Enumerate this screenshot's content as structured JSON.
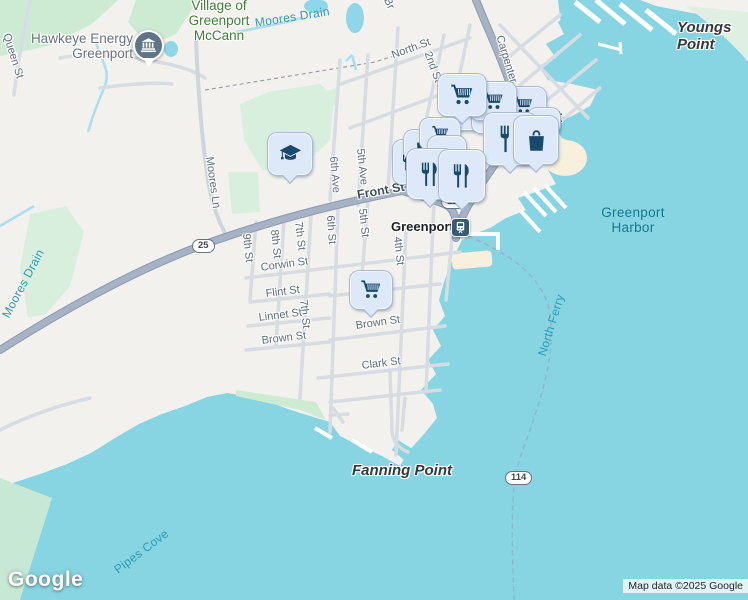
{
  "map": {
    "logo": "Google",
    "attribution": "Map data ©2025 Google",
    "colors": {
      "water": "#87d5e3",
      "land": "#f2f1ee",
      "park": "#cdebd3",
      "shallow": "#c7e8d4",
      "road_major": "#a7b2c4",
      "road_minor": "#d7dce3",
      "marker_bg": "#dde8f8",
      "marker_icon": "#174a6b",
      "station_badge": "#355c77",
      "pin": "#5d7587",
      "water_label": "#157a8d",
      "park_label": "#3f7d37",
      "street_label": "#5d6c7b"
    },
    "labels": [
      {
        "name": "label-hawkeye-energy",
        "cls": "poi-gray halo",
        "text": "Hawkeye Energy\nGreenport",
        "x": 133,
        "y": 31,
        "anchor": "tr",
        "align": "right"
      },
      {
        "name": "label-village-of-greenport-mccann",
        "cls": "poi-green halo",
        "text": "Village of\nGreenport\nMcCann",
        "x": 219,
        "y": -2,
        "anchor": "tc",
        "align": "center"
      },
      {
        "name": "label-youngs-point",
        "cls": "nature halo",
        "text": "Youngs Point",
        "x": 677,
        "y": 20
      },
      {
        "name": "label-fanning-point",
        "cls": "nature halo",
        "text": "Fanning Point",
        "x": 352,
        "y": 463
      },
      {
        "name": "label-greenport-town",
        "cls": "town halo",
        "text": "Greenport",
        "x": 483,
        "y": 109
      },
      {
        "name": "label-greenport-station",
        "cls": "station halo",
        "text": "Greenport",
        "x": 391,
        "y": 220
      },
      {
        "name": "label-greenport-harbor",
        "cls": "water-lg",
        "text": "Greenport\nHarbor",
        "x": 633,
        "y": 205,
        "anchor": "tc",
        "align": "center"
      },
      {
        "name": "label-pipes-cove",
        "cls": "water",
        "text": "Pipes Cove",
        "x": 112,
        "y": 566,
        "rot": -37
      },
      {
        "name": "label-north-ferry",
        "cls": "water",
        "text": "North Ferry",
        "x": 536,
        "y": 354,
        "rot": -73
      },
      {
        "name": "label-moores-drain-top",
        "cls": "water",
        "text": "Moores Drain",
        "x": 254,
        "y": 17,
        "rot": -9
      },
      {
        "name": "label-moores-drain-left",
        "cls": "water",
        "text": "Moores Drain",
        "x": 0,
        "y": 314,
        "rot": -62
      },
      {
        "name": "label-queen-st",
        "cls": "street halo",
        "text": "Queen St",
        "x": 12,
        "y": 32,
        "rot": 73
      },
      {
        "name": "label-north-st",
        "cls": "street halo",
        "text": "North St",
        "x": 390,
        "y": 50,
        "rot": -20
      },
      {
        "name": "label-2nd-st",
        "cls": "street halo",
        "text": "2nd St",
        "x": 433,
        "y": 50,
        "rot": 70
      },
      {
        "name": "label-br-fragment",
        "cls": "street halo",
        "text": "Br",
        "x": 392,
        "y": -4,
        "rot": 65
      },
      {
        "name": "label-carpenter",
        "cls": "street halo",
        "text": "Carpenter",
        "x": 505,
        "y": 34,
        "rot": 73
      },
      {
        "name": "label-moores-ln",
        "cls": "street halo",
        "text": "Moores Ln",
        "x": 215,
        "y": 156,
        "rot": 82
      },
      {
        "name": "label-6th-ave",
        "cls": "street halo",
        "text": "6th Ave",
        "x": 339,
        "y": 156,
        "rot": 85
      },
      {
        "name": "label-5th-ave",
        "cls": "street halo",
        "text": "5th Ave",
        "x": 366,
        "y": 148,
        "rot": 84
      },
      {
        "name": "label-front-st",
        "cls": "street-major halo",
        "text": "Front St",
        "x": 356,
        "y": 188,
        "rot": -10
      },
      {
        "name": "label-9th-st",
        "cls": "street halo",
        "text": "9th St",
        "x": 252,
        "y": 233,
        "rot": 84
      },
      {
        "name": "label-8th-st",
        "cls": "street halo",
        "text": "8th St",
        "x": 280,
        "y": 229,
        "rot": 84
      },
      {
        "name": "label-7th-st-upper",
        "cls": "street halo",
        "text": "7th St",
        "x": 304,
        "y": 221,
        "rot": 83
      },
      {
        "name": "label-6th-st",
        "cls": "street halo",
        "text": "6th St",
        "x": 336,
        "y": 215,
        "rot": 86
      },
      {
        "name": "label-5th-st",
        "cls": "street halo",
        "text": "5th St",
        "x": 368,
        "y": 208,
        "rot": 84
      },
      {
        "name": "label-4th-st",
        "cls": "street halo",
        "text": "4th St",
        "x": 403,
        "y": 236,
        "rot": 84
      },
      {
        "name": "label-7th-st-lower",
        "cls": "street halo",
        "text": "7th St",
        "x": 309,
        "y": 299,
        "rot": 84
      },
      {
        "name": "label-corwin-st",
        "cls": "street halo",
        "text": "Corwin St",
        "x": 260,
        "y": 262,
        "rot": -8
      },
      {
        "name": "label-flint-st",
        "cls": "street halo",
        "text": "Flint St",
        "x": 265,
        "y": 288,
        "rot": -7
      },
      {
        "name": "label-st-fragment",
        "cls": "street halo",
        "text": "St",
        "x": 380,
        "y": 286,
        "rot": -7
      },
      {
        "name": "label-linnet-st",
        "cls": "street halo",
        "text": "Linnet St",
        "x": 258,
        "y": 312,
        "rot": -7
      },
      {
        "name": "label-brown-st-west",
        "cls": "street halo",
        "text": "Brown St",
        "x": 261,
        "y": 335,
        "rot": -7
      },
      {
        "name": "label-brown-st-east",
        "cls": "street halo",
        "text": "Brown St",
        "x": 355,
        "y": 320,
        "rot": -8
      },
      {
        "name": "label-clark-st",
        "cls": "street halo",
        "text": "Clark St",
        "x": 361,
        "y": 360,
        "rot": -7
      }
    ],
    "shields": [
      {
        "name": "route-shield-25",
        "text": "25",
        "x": 192,
        "y": 239
      },
      {
        "name": "route-shield-114-front",
        "text": "114",
        "x": 441,
        "y": 195
      },
      {
        "name": "route-shield-114-ferry",
        "text": "114",
        "x": 505,
        "y": 471
      }
    ],
    "markers": [
      {
        "name": "marker-cart-stack-1",
        "icon": "cart",
        "cls": "stack",
        "x": 449,
        "y": 106,
        "w": 38,
        "h": 22
      },
      {
        "name": "marker-cart-stack-2",
        "icon": "cart",
        "cls": "stack",
        "x": 472,
        "y": 109,
        "w": 38,
        "h": 22
      },
      {
        "name": "marker-cart-stack-3",
        "icon": "cart",
        "cls": "stack",
        "x": 492,
        "y": 104,
        "w": 36,
        "h": 20
      },
      {
        "name": "marker-cart-3",
        "icon": "cart",
        "x": 500,
        "y": 87,
        "w": 44,
        "h": 34
      },
      {
        "name": "marker-cart-2",
        "icon": "cart",
        "x": 470,
        "y": 82,
        "w": 44,
        "h": 36
      },
      {
        "name": "marker-cart-1",
        "icon": "cart",
        "x": 438,
        "y": 74,
        "w": 46,
        "h": 40,
        "tail": true
      },
      {
        "name": "marker-bag-small-right",
        "icon": "bag",
        "x": 528,
        "y": 108,
        "w": 30,
        "h": 24
      },
      {
        "name": "marker-restaurant-left-partial",
        "icon": "restaurant",
        "x": 393,
        "y": 140,
        "w": 30,
        "h": 42
      },
      {
        "name": "marker-bag-small-left",
        "icon": "bag",
        "x": 404,
        "y": 130,
        "w": 34,
        "h": 28
      },
      {
        "name": "marker-cart-small-left",
        "icon": "cart",
        "x": 420,
        "y": 118,
        "w": 38,
        "h": 30
      },
      {
        "name": "marker-stack-left",
        "icon": "cart",
        "cls": "stack",
        "x": 428,
        "y": 136,
        "w": 36,
        "h": 20
      },
      {
        "name": "marker-restaurant-big",
        "icon": "restaurant",
        "x": 484,
        "y": 113,
        "w": 50,
        "h": 50,
        "tail": true
      },
      {
        "name": "marker-bag-big",
        "icon": "bag",
        "x": 514,
        "y": 116,
        "w": 42,
        "h": 46,
        "tail": true
      },
      {
        "name": "marker-restaurant-pair-1",
        "icon": "restaurant",
        "x": 407,
        "y": 149,
        "w": 44,
        "h": 48,
        "tail": true
      },
      {
        "name": "marker-restaurant-pair-2",
        "icon": "restaurant",
        "x": 439,
        "y": 150,
        "w": 44,
        "h": 50,
        "tail": true
      },
      {
        "name": "marker-grocery-brown-st",
        "icon": "cart",
        "x": 350,
        "y": 271,
        "w": 40,
        "h": 36,
        "tail": true
      },
      {
        "name": "marker-school",
        "icon": "school",
        "x": 268,
        "y": 133,
        "w": 42,
        "h": 40,
        "tail": true
      },
      {
        "name": "marker-train-station",
        "icon": "train",
        "cls": "badge",
        "x": 451,
        "y": 218,
        "w": 17,
        "h": 17
      },
      {
        "name": "marker-hawkeye-plant",
        "icon": "museum",
        "cls": "pin",
        "x": 133,
        "y": 30,
        "w": 27,
        "h": 27
      }
    ]
  }
}
